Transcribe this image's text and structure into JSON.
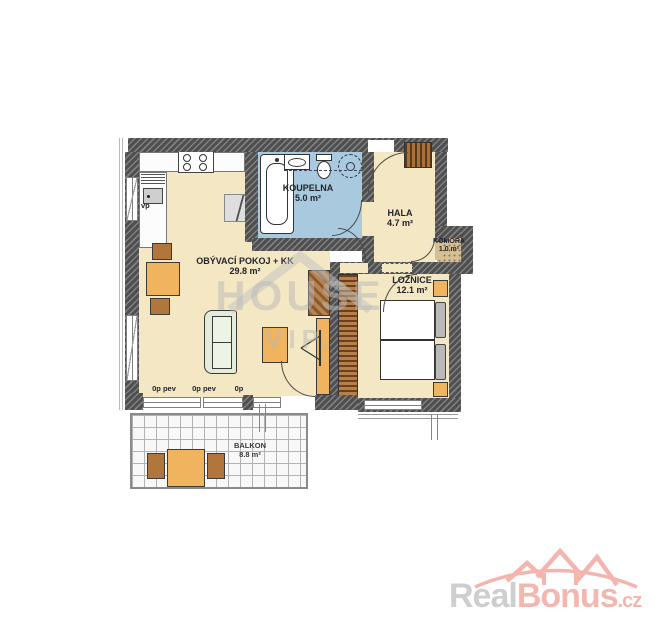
{
  "plan": {
    "rooms": [
      {
        "id": "obyvaci-pokoj",
        "name": "OBÝVACÍ POKOJ + KK",
        "area": "29.8 m²"
      },
      {
        "id": "koupelna",
        "name": "KOUPELNA",
        "area": "5.0 m²"
      },
      {
        "id": "hala",
        "name": "HALA",
        "area": "4.7 m²"
      },
      {
        "id": "komora",
        "name": "KOMORA",
        "area": "1.0 m²"
      },
      {
        "id": "loznice",
        "name": "LOŽNICE",
        "area": "12.1 m²"
      },
      {
        "id": "balkon",
        "name": "BALKON",
        "area": "8.8 m²"
      }
    ],
    "labels": {
      "sink": "vp",
      "window_1": "0p pev",
      "window_2": "0p pev",
      "window_3": "0p"
    },
    "colors": {
      "wall": "#4f4f4f",
      "floor": "#f4e7c3",
      "bathroom_floor": "#a9cade",
      "komora_floor": "#d5bf94",
      "furniture_orange": "#f1b45e",
      "furniture_brown": "#b0763b",
      "sofa_green": "#e3ecd9",
      "balcony_grid": "#b2b2b2"
    }
  },
  "watermark": {
    "text": "HOUSE",
    "sub": "VIP."
  },
  "logo": {
    "part_gray": "Real",
    "part_pink": "Bonus",
    "part_domain": ".cz",
    "color_gray": "#cecece",
    "color_pink": "#f3b7b0"
  }
}
